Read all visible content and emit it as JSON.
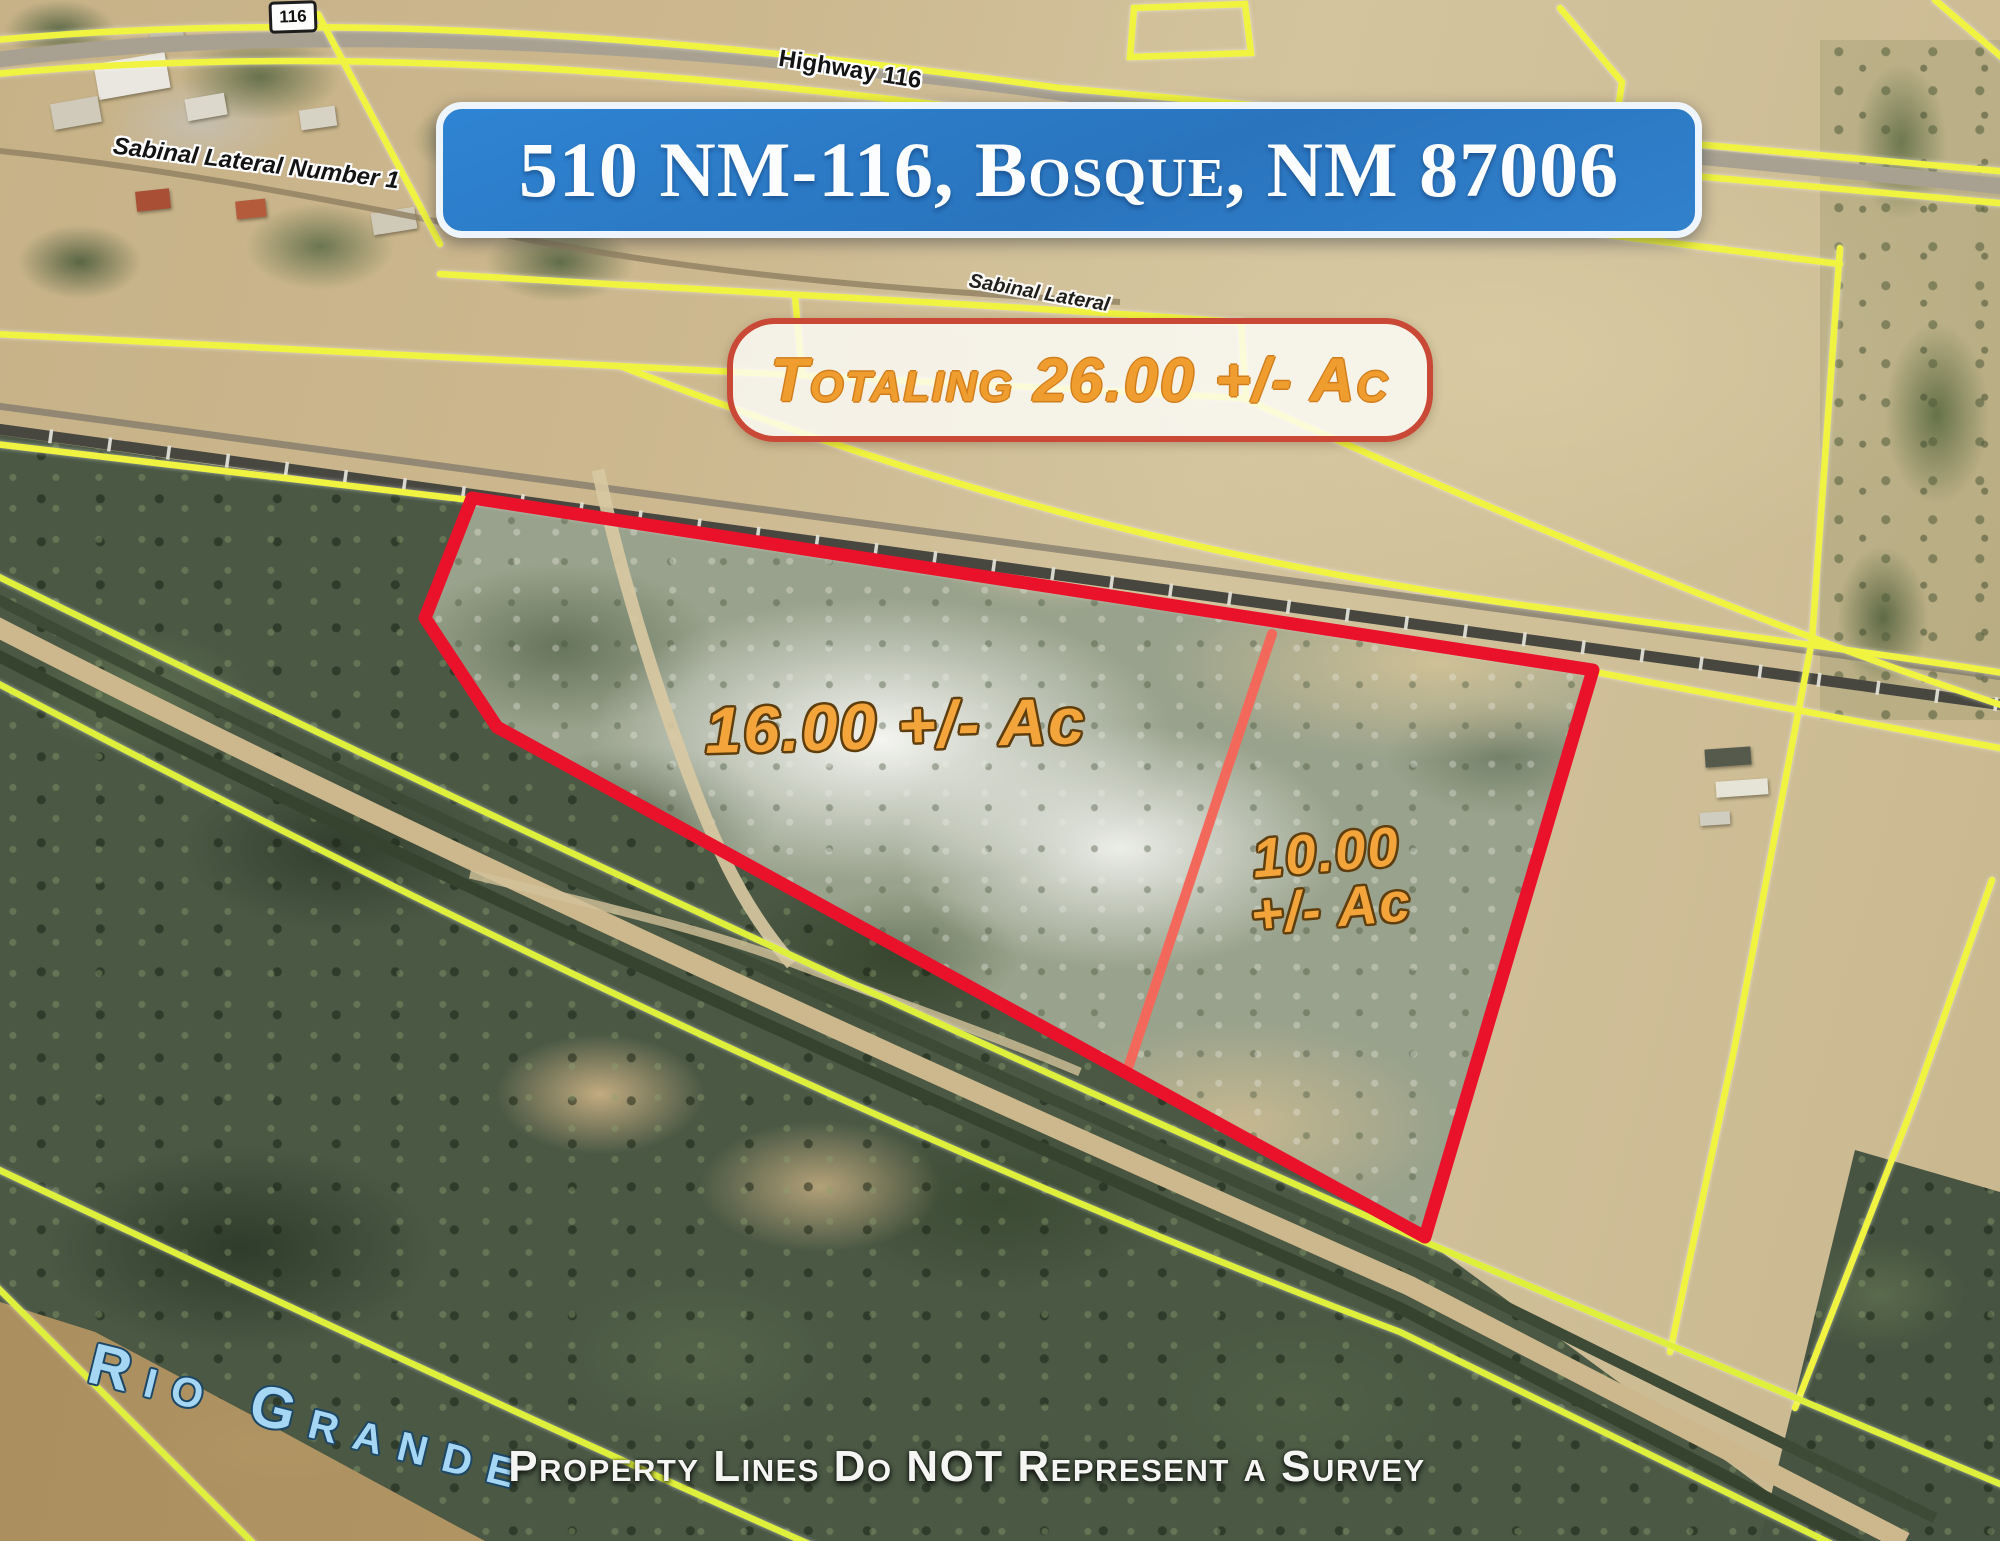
{
  "banner": {
    "address": "510 NM-116, Bosque, NM 87006"
  },
  "total_callout": {
    "label": "Totaling 26.00 +/- Ac"
  },
  "parcels": {
    "west": {
      "area_label": "16.00 +/- Ac"
    },
    "east": {
      "area_line1": "10.00",
      "area_line2": "+/- Ac"
    }
  },
  "map_labels": {
    "route_shield": "116",
    "highway": "Highway 116",
    "lateral_canal": "Sabinal Lateral Number 1",
    "lateral_canal_short": "Sabinal Lateral",
    "river": "Rio Grande"
  },
  "disclaimer": "Property Lines Do NOT Represent a Survey",
  "colors": {
    "banner_blue": "#2e7fc9",
    "boundary_red": "#e9122a",
    "divider_salmon": "#f2695c",
    "parcel_line_yellow": "#f0f33f",
    "acreage_orange": "#f3a53c",
    "river_label_blue": "#a5d7f5"
  }
}
